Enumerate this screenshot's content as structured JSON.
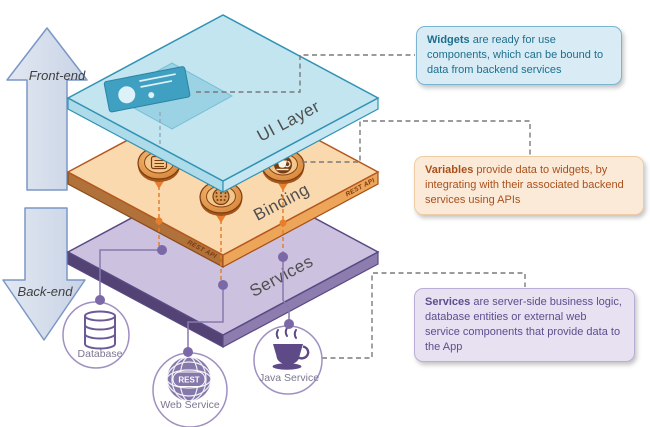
{
  "arrows": {
    "front": "Front-end",
    "back": "Back-end"
  },
  "layers": {
    "ui": {
      "label": "UI Layer"
    },
    "binding": {
      "label": "Binding",
      "edge_label": "REST API"
    },
    "services": {
      "label": "Services"
    }
  },
  "callouts": {
    "widgets": {
      "bold": "Widgets",
      "rest": " are ready for use components, which can be bound to data from backend services"
    },
    "variables": {
      "bold": "Variables",
      "rest": " provide data to widgets, by integrating with their associated backend services using APIs"
    },
    "services": {
      "bold": "Services",
      "rest": " are server-side business logic, database entities or external web service components that provide data to the App"
    }
  },
  "nodes": {
    "database": {
      "label": "Database"
    },
    "web": {
      "label": "Web Service",
      "badge": "REST"
    },
    "java": {
      "label": "Java Service"
    }
  },
  "colors": {
    "ui_fill": "#c3e5f0",
    "ui_stroke": "#3193b4",
    "binding_fill": "#fbd9af",
    "binding_stroke": "#b5581d",
    "services_fill": "#ccc1df",
    "services_stroke": "#5a4a84",
    "widgets_text": "#1d6f8e",
    "variables_text": "#a8511c",
    "services_text": "#5d4e8e",
    "connector_gray": "#7a7a7a",
    "connector_orange": "#e67f2b",
    "connector_purple": "#8a79ad",
    "arrow_fill": "#d7dfec",
    "arrow_stroke": "#7b97c6"
  }
}
